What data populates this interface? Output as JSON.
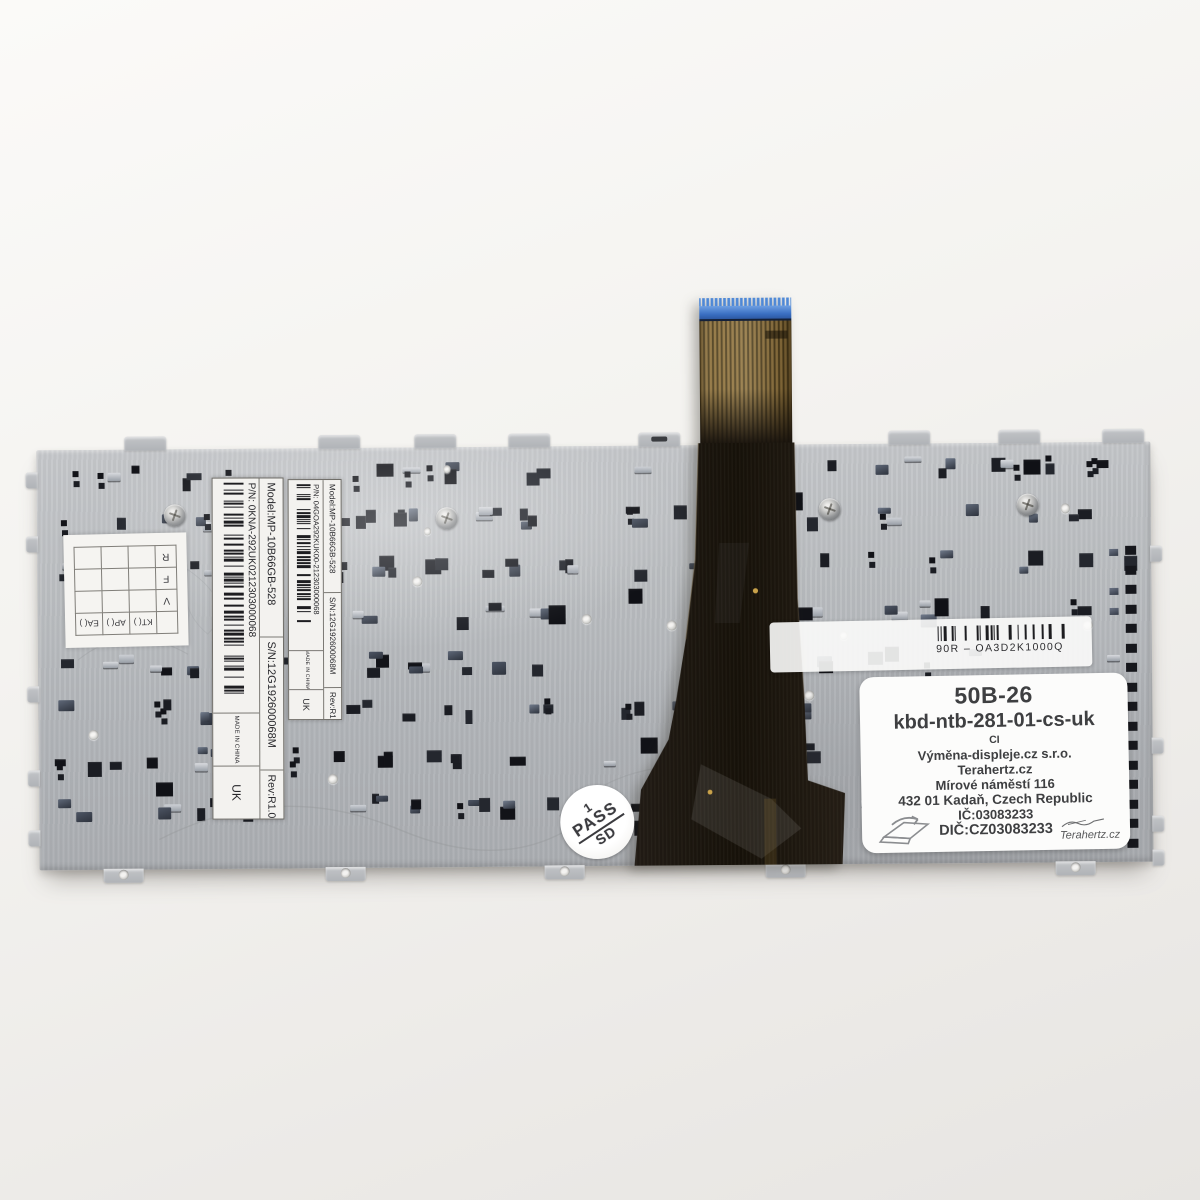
{
  "plate": {
    "etched_code": "305A300600UP4 L1 D1"
  },
  "stamp": {
    "top": "1",
    "middle": "PASS",
    "bottom": "SD"
  },
  "oem_label": {
    "code": "90R – OA3D2K1000Q"
  },
  "qc_grid": {
    "letters": [
      "R",
      "F",
      "V"
    ],
    "checks": [
      "EA( )",
      "AP( )",
      "KT( )"
    ]
  },
  "model_sticker_large": {
    "model": "Model:MP-10B66GB-528",
    "serial": "S/N:12G192600068M",
    "rev": "Rev:R1.0",
    "part": "P/N: 0KNA-292UK0212303000068",
    "made_in": "MADE IN CHINA",
    "market": "UK"
  },
  "model_sticker_small": {
    "model": "Model:MP-10B66GB-528",
    "serial": "S/N:12G192600068M",
    "rev": "Rev:R1.0",
    "part": "P/N: 04GOA292KUK00-212303000068",
    "made_in": "MADE IN CHINA",
    "market": "UK"
  },
  "seller_sticker": {
    "code": "50B-26",
    "product": "kbd-ntb-281-01-cs-uk",
    "variant": "CI",
    "company": "Výměna-displeje.cz s.r.o.",
    "brand": "Terahertz.cz",
    "street": "Mírové náměstí 116",
    "city": "432 01 Kadaň, Czech Republic",
    "ic": "IČ:03083233",
    "dic": "DIČ:CZ03083233",
    "signature": "Terahertz.cz"
  }
}
